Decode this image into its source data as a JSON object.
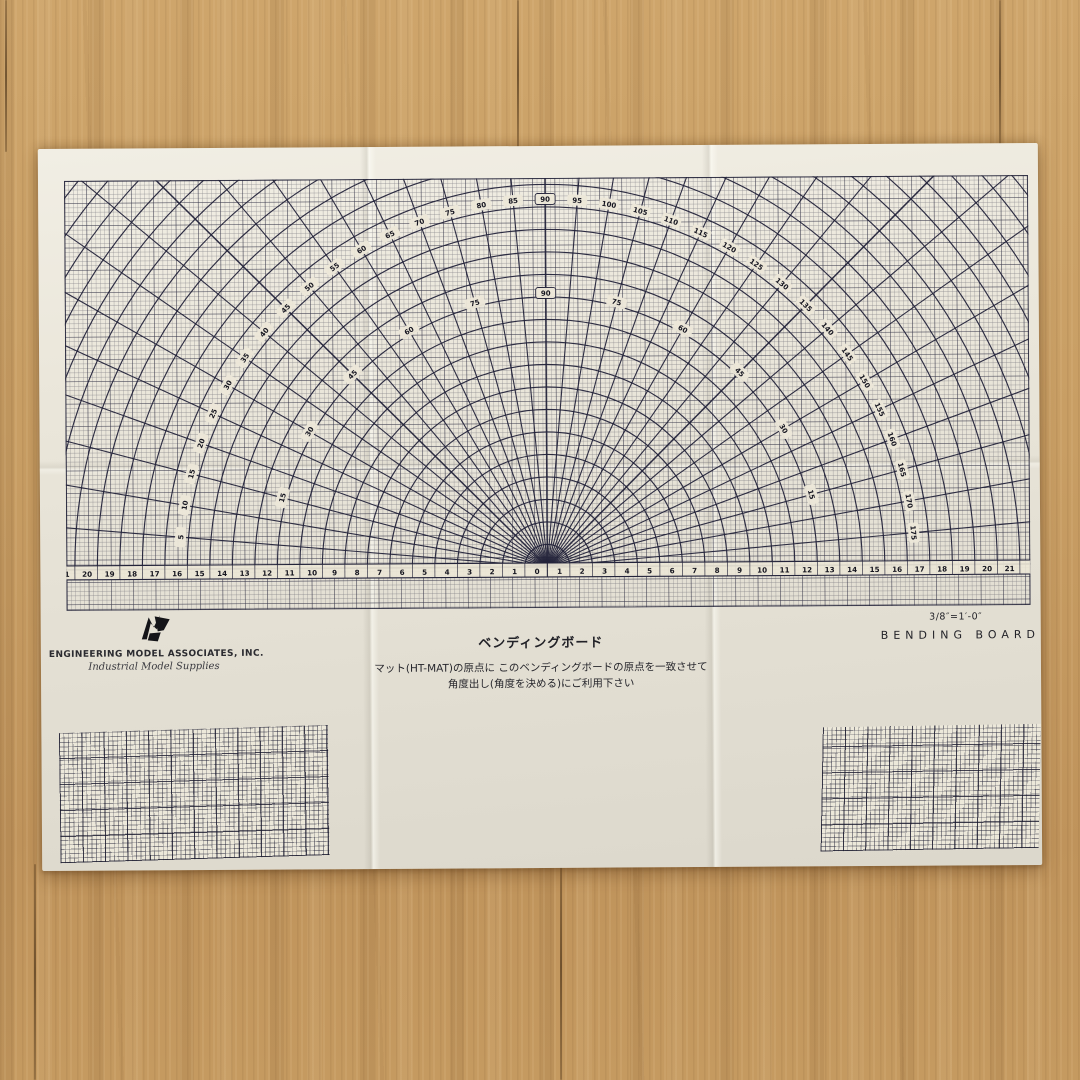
{
  "colors": {
    "ink": "#23233a",
    "paper": "#ebe7db",
    "ruler_band": "#ece6d6",
    "label_pill": "#ece7d8",
    "wood": "#c79e66",
    "logo_black": "#141418"
  },
  "chart_data": {
    "type": "protractor_grid",
    "title": "ベンディングボード (bending board protractor over graph grid)",
    "unit_px": 22.5,
    "radial_step_deg": 5,
    "circle_count": 28,
    "outer_label_radius_px": 368,
    "inner_label_radius_px": 274,
    "outer_degree_labels": [
      5,
      10,
      15,
      20,
      25,
      30,
      35,
      40,
      45,
      50,
      55,
      60,
      65,
      70,
      75,
      80,
      85,
      90,
      95,
      100,
      105,
      110,
      115,
      120,
      125,
      130,
      135,
      140,
      145,
      150,
      155,
      160,
      165,
      170,
      175
    ],
    "inner_degree_labels": [
      15,
      30,
      45,
      60,
      75,
      90,
      75,
      60,
      45,
      30,
      15
    ],
    "inner_label_step_deg": 15,
    "boxed_label": 90,
    "ruler": {
      "min": -21,
      "max": 21,
      "step": 1,
      "labels": [
        21,
        20,
        19,
        18,
        17,
        16,
        15,
        14,
        13,
        12,
        11,
        10,
        9,
        8,
        7,
        6,
        5,
        4,
        3,
        2,
        1,
        0,
        1,
        2,
        3,
        4,
        5,
        6,
        7,
        8,
        9,
        10,
        11,
        12,
        13,
        14,
        15,
        16,
        17,
        18,
        19,
        20,
        21
      ]
    }
  },
  "footer": {
    "company_name": "ENGINEERING MODEL ASSOCIATES, INC.",
    "company_tagline": "Industrial Model Supplies",
    "title_jp": "ベンディングボード",
    "instruction_line1": "マット(HT-MAT)の原点に このベンディングボードの原点を一致させて",
    "instruction_line2": "角度出し(角度を決める)にご利用下さい",
    "scale_note": "3/8″=1′-0″",
    "product_name_en": "BENDING BOARD"
  }
}
